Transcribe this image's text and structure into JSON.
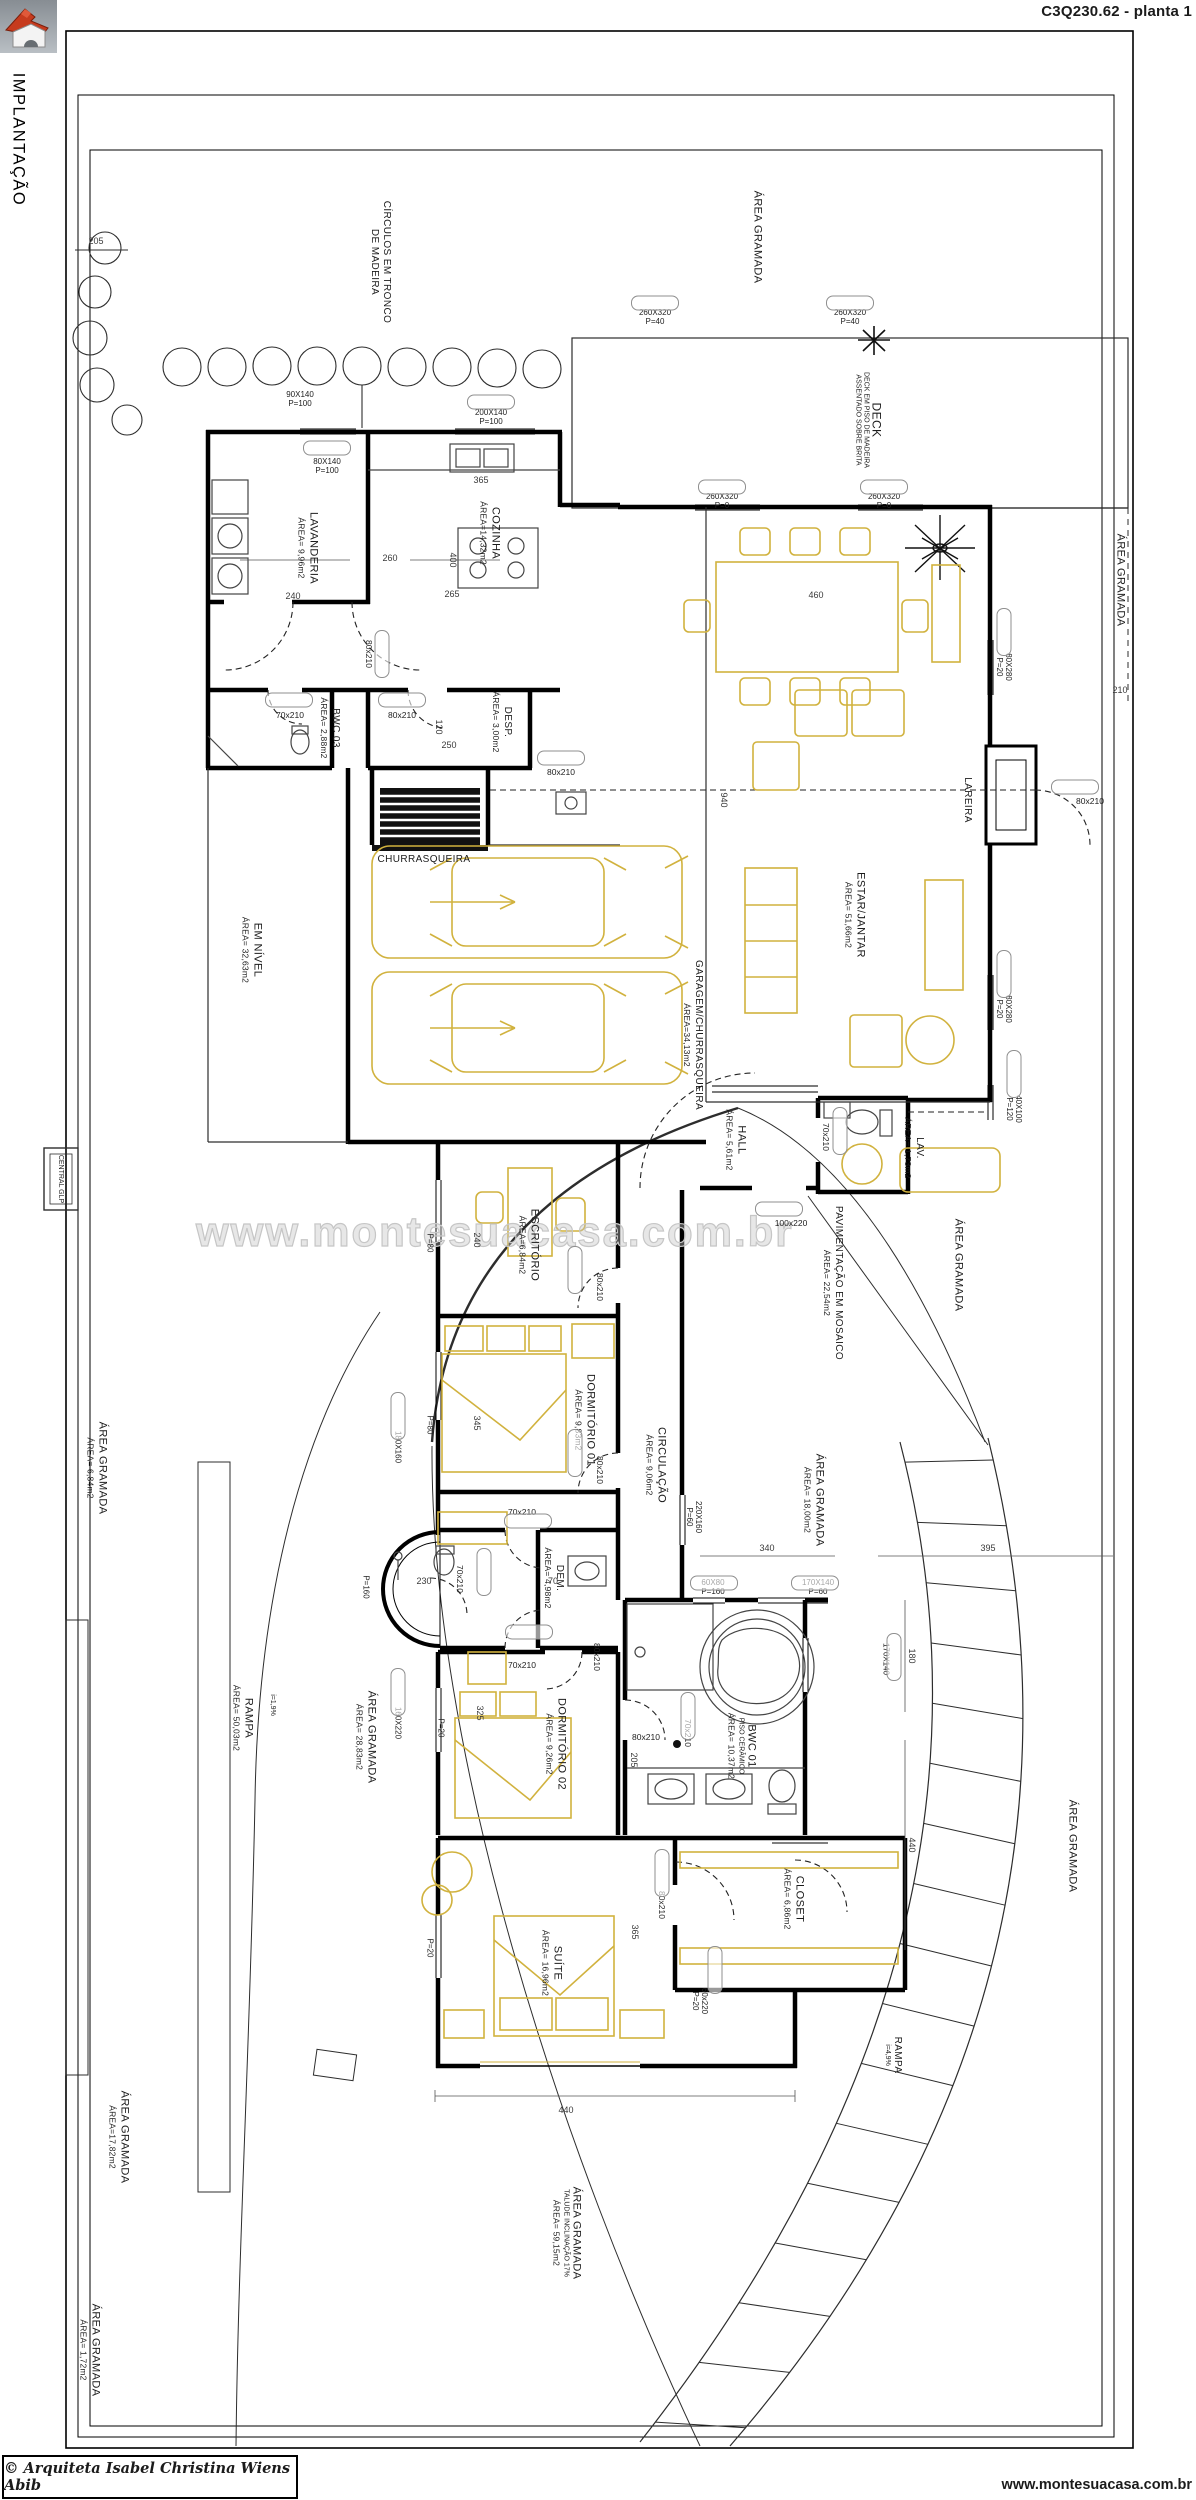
{
  "meta": {
    "title": "C3Q230.62 - planta 1",
    "side_label": "IMPLANTAÇÃO"
  },
  "footer": {
    "copyright": "© Arquiteta Isabel Christina Wiens Abib",
    "website": "www.montesuacasa.com.br"
  },
  "watermark": "www.montesuacasa.com.br",
  "colors": {
    "furniture": "#d1b23e",
    "walls": "#000000",
    "logo_roof": "#c63b1e"
  },
  "icons": {
    "logo": "house-logo-icon",
    "north": "north-star-icon",
    "plant": "plant-icon"
  },
  "site_labels": {
    "circulos_1": "CÍRCULOS EM TRONCO",
    "circulos_2": "DE MADEIRA",
    "central_glp": "CENTRAL GLP"
  },
  "rooms": {
    "lavanderia": {
      "name": "LAVANDERIA",
      "area": "ÁREA= 9,96m2"
    },
    "cozinha": {
      "name": "COZINHA",
      "area": "ÁREA=14,32m2"
    },
    "bwc03": {
      "name": "BWC 03",
      "area": "ÁREA= 2,88m2"
    },
    "desp": {
      "name": "DESP.",
      "area": "ÁREA= 3,00m2"
    },
    "churrasqueira": {
      "name": "CHURRASQUEIRA"
    },
    "em_nivel": {
      "name": "EM NÍVEL",
      "area": "ÁREA= 32,63m2"
    },
    "garagem": {
      "name": "GARAGEM/CHURRASQUEIRA",
      "area": "ÁREA=34,13m2"
    },
    "estar": {
      "name": "ESTAR/JANTAR",
      "area": "ÁREA= 51,66m2"
    },
    "lareira": {
      "name": "LAREIRA"
    },
    "deck": {
      "name": "DECK",
      "sub1": "DECK EM PISO DE MADEIRA",
      "sub2": "ASSENTADO SOBRE BRITA"
    },
    "hall": {
      "name": "HALL",
      "area": "ÁREA= 5,61m2"
    },
    "lav": {
      "name": "LAV.",
      "area": "ÁREA= 1,73m2"
    },
    "pav": {
      "name": "PAVIMENTAÇÃO EM MOSAICO",
      "area": "ÁREA= 22,54m2"
    },
    "escritorio": {
      "name": "ESCRITÓRIO",
      "area": "ÁREA=6,84m2"
    },
    "dorm01": {
      "name": "DORMITÓRIO 01",
      "area": "ÁREA= 9,83m2"
    },
    "circulacao": {
      "name": "CIRCULAÇÃO",
      "area": "ÁREA= 9,06m2"
    },
    "dem": {
      "name": "DEM.",
      "area": "ÁREA= 4,98m2"
    },
    "dorm02": {
      "name": "DORMITÓRIO 02",
      "area": "ÁREA= 9,26m2"
    },
    "bwc01": {
      "name": "BWC 01",
      "sub": "PISO CERÂMICO",
      "area": "ÁREA= 10,37m2"
    },
    "closet": {
      "name": "CLOSET",
      "area": "ÁREA= 6,86m2"
    },
    "suite": {
      "name": "SUÍTE",
      "area": "ÁREA= 16,96m2"
    },
    "rampa_left": {
      "name": "RAMPA",
      "area": "ÁREA= 50,03m2",
      "slope": "i=1,9%"
    },
    "rampa_right": {
      "name": "RAMPA",
      "slope": "i=4,9%"
    }
  },
  "green": {
    "g_top": {
      "name": "ÁREA GRAMADA"
    },
    "g_right1": {
      "name": "ÁREA GRAMADA"
    },
    "g_right2": {
      "name": "ÁREA GRAMADA"
    },
    "g_mid": {
      "name": "ÁREA GRAMADA",
      "area": "ÁREA= 18,00m2"
    },
    "g_left": {
      "name": "ÁREA GRAMADA",
      "area": "ÁREA= 6,84m2"
    },
    "g_rampa": {
      "name": "ÁREA GRAMADA",
      "area": "ÁREA= 28,83m2"
    },
    "g_bl": {
      "name": "ÁREA GRAMADA",
      "area": "ÁREA=17,82m2"
    },
    "g_bot": {
      "name": "ÁREA GRAMADA",
      "sub": "TALUDE INCLINAÇÃO 17%",
      "area": "ÁREA= 59,15m2"
    },
    "g_redge": {
      "name": "ÁREA GRAMADA"
    },
    "g_blc": {
      "name": "ÁREA GRAMADA",
      "area": "ÁREA= 1,72m2"
    }
  },
  "annotations": {
    "dims": [
      "205",
      "240",
      "265",
      "365",
      "400",
      "260",
      "460",
      "940",
      "210",
      "120",
      "250",
      "240",
      "345",
      "340",
      "395",
      "180",
      "440",
      "230",
      "70",
      "325",
      "365",
      "440",
      "205"
    ],
    "specs": [
      {
        "a": "200X140",
        "b": "P=100"
      },
      {
        "a": "90X140",
        "b": "P=100"
      },
      {
        "a": "80X140",
        "b": "P=100"
      },
      {
        "a": "260X320",
        "b": "P=40"
      },
      {
        "a": "260X320",
        "b": "P=40"
      },
      {
        "a": "260X320",
        "b": "P=0"
      },
      {
        "a": "260X320",
        "b": "P=0"
      },
      {
        "a": "80X280",
        "b": "P=20"
      },
      {
        "a": "80X280",
        "b": "P=20"
      },
      {
        "a": "40X100",
        "b": "P=120"
      },
      {
        "a": "220X160",
        "b": "P=60"
      },
      {
        "a": "60X80",
        "b": "P=160"
      },
      {
        "a": "170X140",
        "b": "P=60"
      },
      {
        "a": "170X140",
        "b": ""
      },
      {
        "a": "160X220",
        "b": ""
      },
      {
        "a": "180X160",
        "b": ""
      },
      {
        "a": "60x220",
        "b": "P=20"
      },
      {
        "a": "P=160",
        "b": ""
      },
      {
        "a": "P=20",
        "b": ""
      },
      {
        "a": "P=80",
        "b": ""
      },
      {
        "a": "P=80",
        "b": ""
      },
      {
        "a": "P=20",
        "b": ""
      }
    ],
    "doors": [
      "80x210",
      "70x210",
      "80x210",
      "80x210",
      "80x210",
      "70x210",
      "100x220",
      "80x210",
      "80x210",
      "70x210",
      "70x210",
      "70x210",
      "80x210",
      "80x210",
      "70x210",
      "80x210"
    ]
  }
}
